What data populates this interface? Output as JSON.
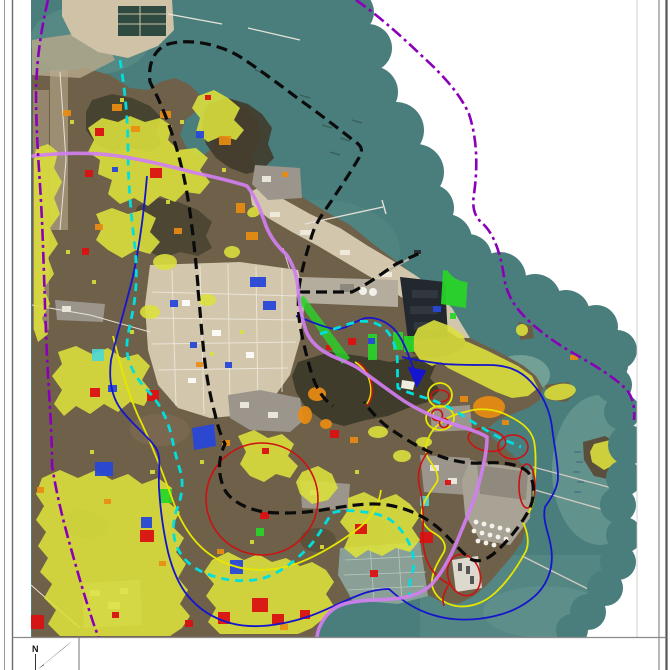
{
  "compass": {
    "label": "N"
  },
  "palette": {
    "page_bg": "#ffffff",
    "sea": "#497e7c",
    "sea_shallow": "#7aa89b",
    "land": "#6f6049",
    "land_dark": "#43402f",
    "land_clear": "#d2c6ac",
    "urban": "#9b958b",
    "frame_line": "#8a8a8a"
  },
  "layers": {
    "vegetation": {
      "name": "vegetation-overlay",
      "color": "#dde23c"
    },
    "orange": {
      "name": "orange-overlay",
      "color": "#ea8c12"
    },
    "red": {
      "name": "red-overlay",
      "color": "#da1212"
    },
    "green": {
      "name": "green-overlay",
      "color": "#28d628"
    },
    "blue": {
      "name": "blue-overlay",
      "color": "#2847d8"
    },
    "cyan_patch": {
      "name": "cyan-overlay",
      "color": "#49d8d8"
    },
    "outer_boundary": {
      "name": "outer-boundary-dashdot",
      "color": "#8a00b8"
    },
    "planning_boundary": {
      "name": "planning-boundary-dashed",
      "color": "#0b0b0b"
    },
    "road": {
      "name": "main-road",
      "color": "#d07ff0"
    },
    "channel": {
      "name": "channel-dashed",
      "color": "#00dede"
    },
    "buffer_blue": {
      "name": "blue-buffer-contour",
      "color": "#1515cd"
    },
    "buffer_yellow": {
      "name": "yellow-buffer-contour",
      "color": "#e6e600"
    },
    "facility_red": {
      "name": "red-facility-contour",
      "color": "#cc1111"
    }
  }
}
